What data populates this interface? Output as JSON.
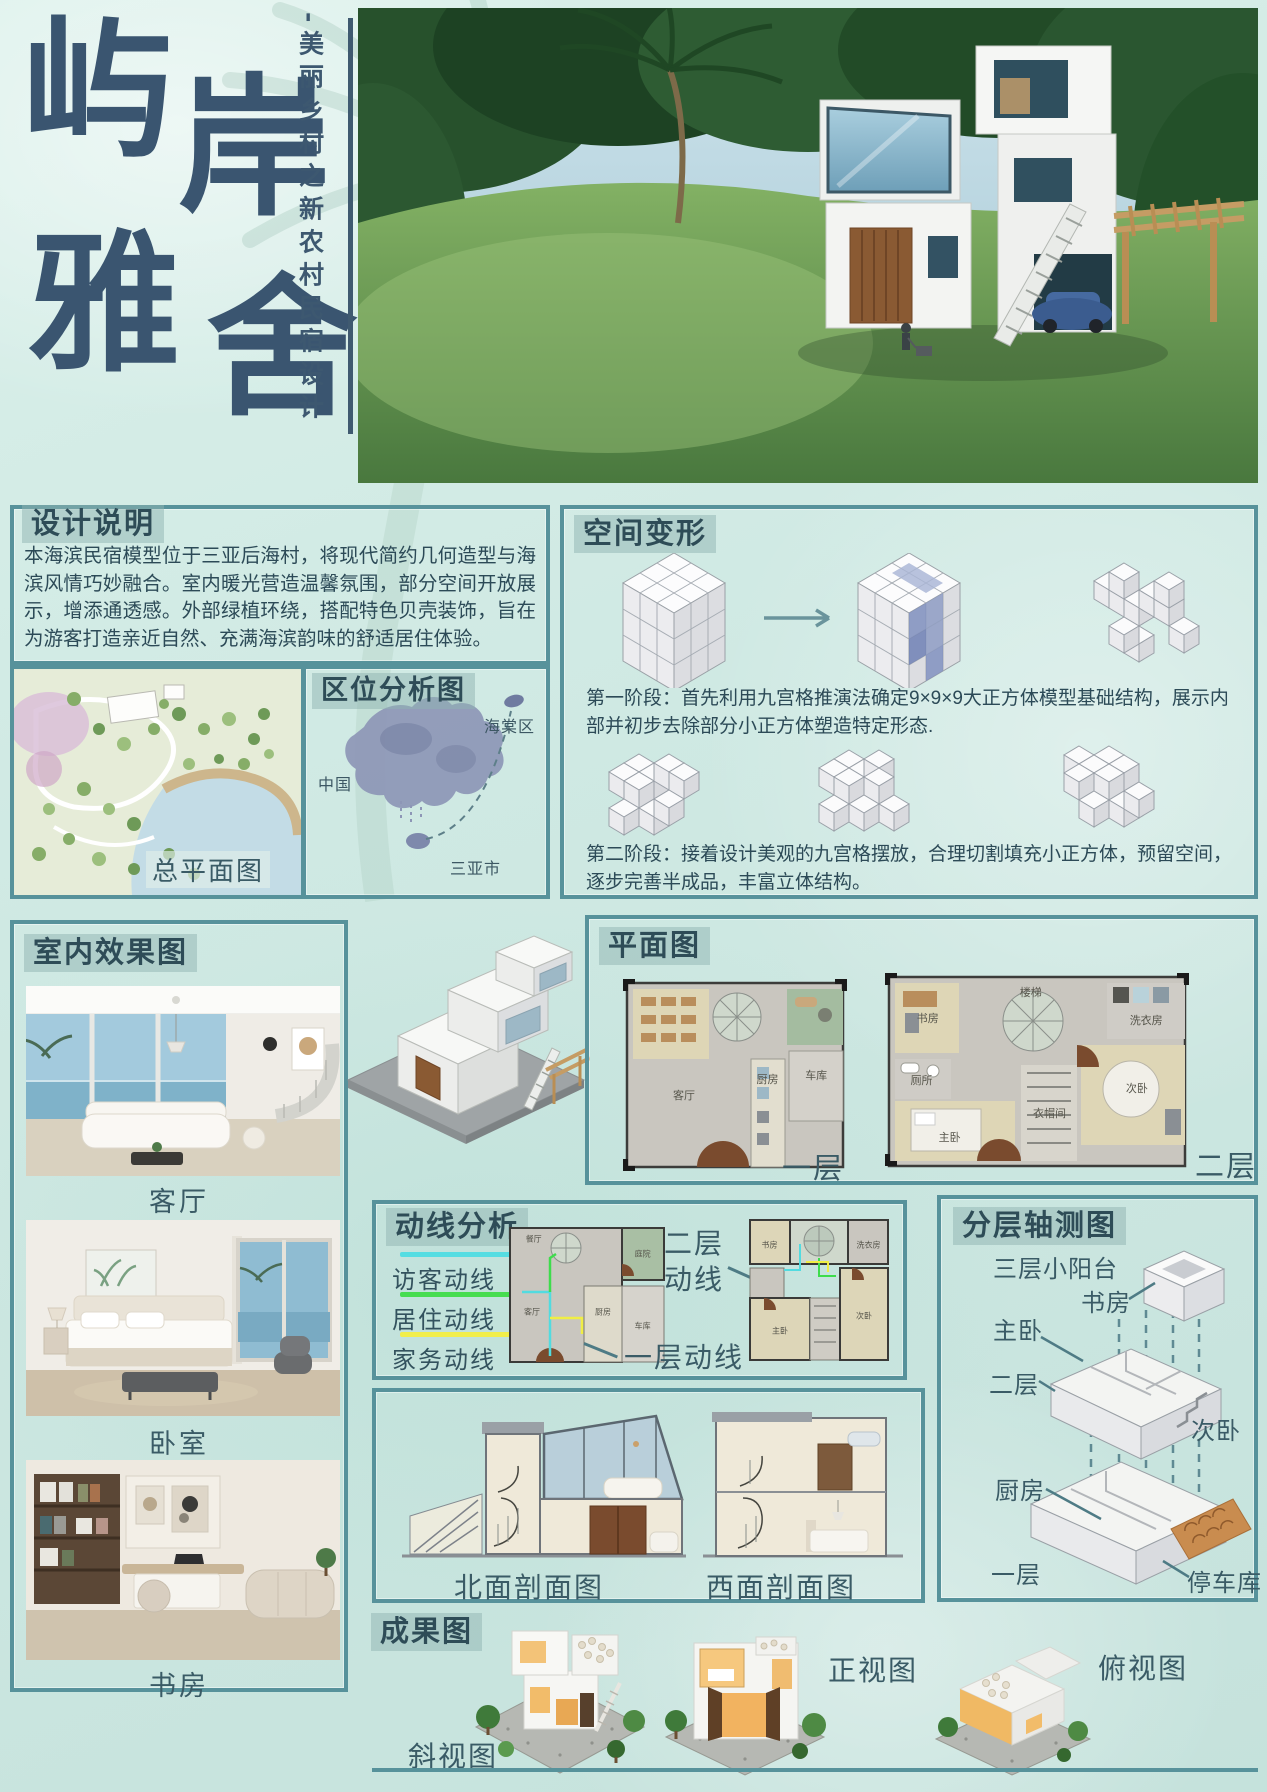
{
  "header": {
    "title_chars": [
      "屿",
      "岸",
      "雅",
      "舍"
    ],
    "subtitle": "-美丽乡村之新农村民宿设计"
  },
  "design_notes": {
    "title": "设计说明",
    "body": "本海滨民宿模型位于三亚后海村，将现代简约几何造型与海滨风情巧妙融合。室内暖光营造温馨氛围，部分空间开放展示，增添通透感。外部绿植环绕，搭配特色贝壳装饰，旨在为游客打造亲近自然、充满海滨韵味的舒适居住体验。"
  },
  "space_transform": {
    "title": "空间变形",
    "stage1": "第一阶段：首先利用九宫格推演法确定9×9×9大正方体模型基础结构，展示内部并初步去除部分小正方体塑造特定形态.",
    "stage2": "第二阶段：接着设计美观的九宫格摆放，合理切割填充小正方体，预留空间，逐步完善半成品，丰富立体结构。"
  },
  "master_plan": {
    "label": "总平面图"
  },
  "location": {
    "title": "区位分析图",
    "district": "海棠区",
    "country": "中国",
    "city": "三亚市"
  },
  "interior": {
    "title": "室内效果图",
    "captions": [
      "客厅",
      "卧室",
      "书房"
    ]
  },
  "floor_plans": {
    "title": "平面图",
    "floor1": {
      "label": "一层",
      "living": "客厅",
      "kitchen": "厨房",
      "garage": "车库"
    },
    "floor2": {
      "label": "二层",
      "stairs": "楼梯",
      "study": "书房",
      "laundry": "洗衣房",
      "toilet": "厕所",
      "closet": "衣帽间",
      "master": "主卧",
      "second": "次卧"
    }
  },
  "circulation": {
    "title": "动线分析",
    "legend": [
      {
        "label": "访客动线",
        "color": "#55dde2"
      },
      {
        "label": "居住动线",
        "color": "#46dd50"
      },
      {
        "label": "家务动线",
        "color": "#f1ee4b"
      }
    ],
    "floor2_label": "二层动线",
    "floor1_label": "一层动线",
    "mini1": {
      "dining": "餐厅",
      "patio": "庭院",
      "living": "客厅",
      "kitchen": "厨房",
      "garage": "车库"
    },
    "mini2": {
      "study": "书房",
      "laundry": "洗衣房",
      "master": "主卧",
      "second": "次卧"
    }
  },
  "axon": {
    "title": "分层轴测图",
    "balcony": "三层小阳台",
    "study": "书房",
    "master": "主卧",
    "floor2": "二层",
    "second": "次卧",
    "kitchen": "厨房",
    "floor1": "一层",
    "garage": "停车库"
  },
  "sections": {
    "north": "北面剖面图",
    "west": "西面剖面图"
  },
  "results": {
    "title": "成果图",
    "oblique": "斜视图",
    "front": "正视图",
    "top": "俯视图"
  },
  "colors": {
    "accent_border": "#57929b",
    "title_text": "#2e4c57",
    "calligraphy": "#3a5570"
  }
}
